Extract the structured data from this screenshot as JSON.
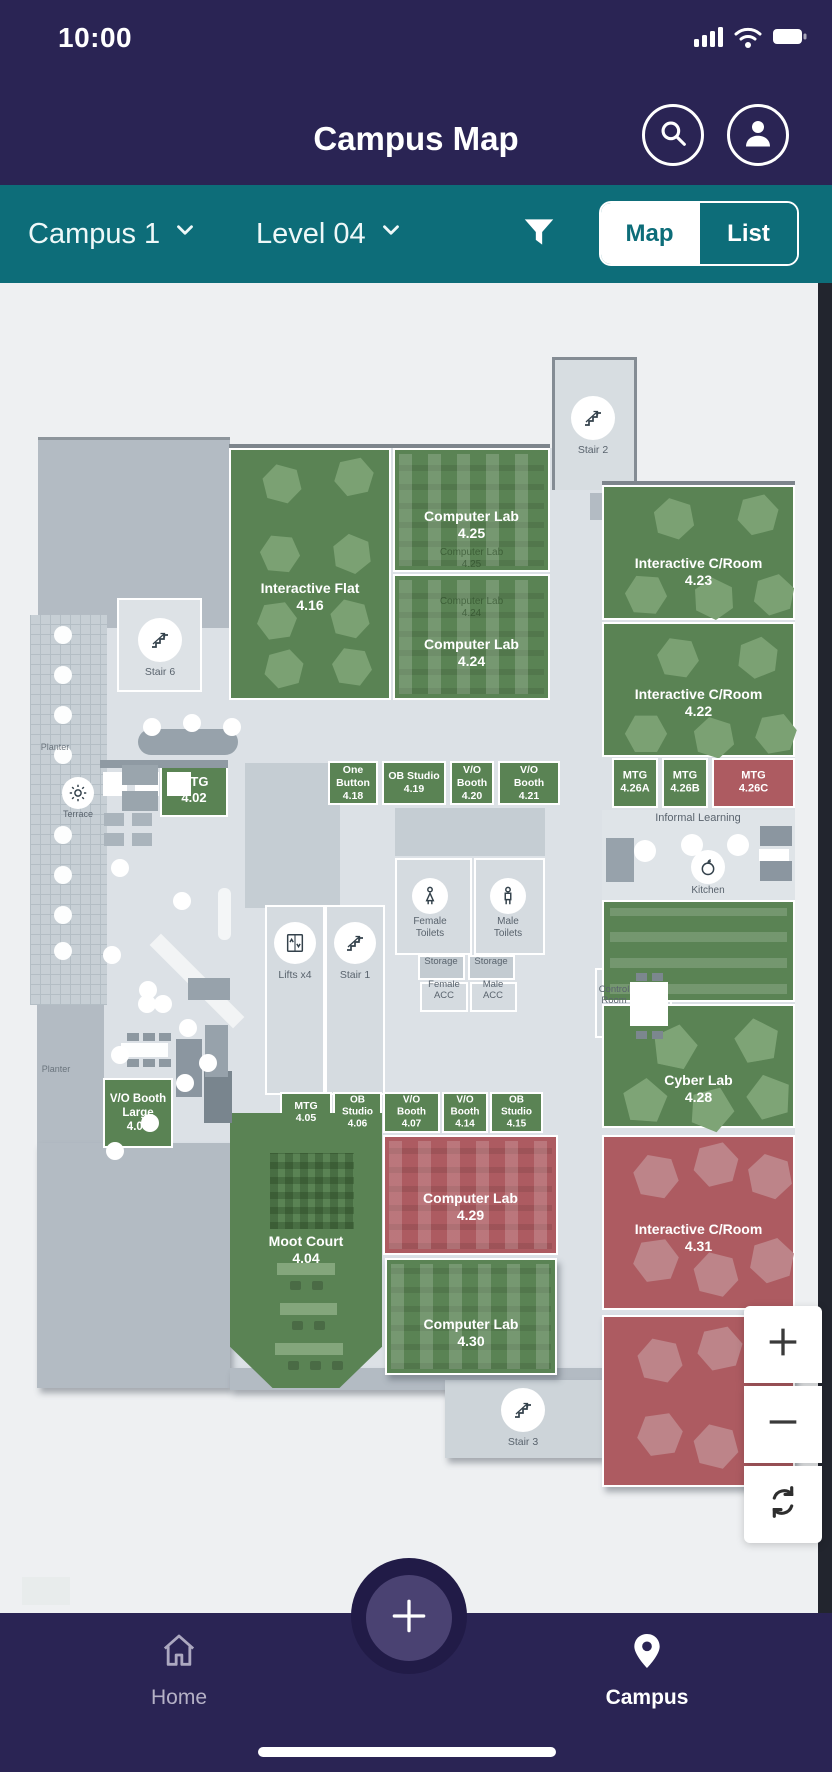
{
  "colors": {
    "navy": "#2a2454",
    "teal": "#0d6d79",
    "green_room": "#5a8354",
    "red_room": "#ad5b61",
    "map_bg": "#eef0f2",
    "floor": "#dce1e6"
  },
  "status": {
    "time": "10:00"
  },
  "header": {
    "title": "Campus Map"
  },
  "filter": {
    "campus": "Campus 1",
    "level": "Level 04",
    "map_label": "Map",
    "list_label": "List",
    "selected": "Map"
  },
  "nav": {
    "home": "Home",
    "campus": "Campus"
  },
  "map": {
    "rooms": [
      {
        "id": "interactive-flat-416",
        "lines": [
          "Interactive Flat",
          "4.16"
        ],
        "x": 229,
        "y": 165,
        "w": 162,
        "h": 252,
        "color": "green",
        "fs": 14,
        "labelTop": 130
      },
      {
        "id": "computer-lab-425",
        "lines": [
          "Computer Lab",
          "4.25"
        ],
        "x": 393,
        "y": 165,
        "w": 157,
        "h": 124,
        "color": "green",
        "fs": 14,
        "labelTop": 58,
        "pattern": "cols",
        "caption": {
          "lines": [
            "Computer Lab",
            "4.25"
          ],
          "top": 97
        }
      },
      {
        "id": "computer-lab-424",
        "lines": [
          "Computer Lab",
          "4.24"
        ],
        "x": 393,
        "y": 291,
        "w": 157,
        "h": 126,
        "color": "green",
        "fs": 14,
        "labelTop": 60,
        "pattern": "cols",
        "caption": {
          "lines": [
            "Computer Lab",
            "4.24"
          ],
          "top": 20
        }
      },
      {
        "id": "interactive-croom-423",
        "lines": [
          "Interactive C/Room",
          "4.23"
        ],
        "x": 602,
        "y": 202,
        "w": 193,
        "h": 135,
        "color": "green",
        "fs": 14,
        "labelTop": 68
      },
      {
        "id": "interactive-croom-422",
        "lines": [
          "Interactive C/Room",
          "4.22"
        ],
        "x": 602,
        "y": 339,
        "w": 193,
        "h": 135,
        "color": "green",
        "fs": 14,
        "labelTop": 62
      },
      {
        "id": "mtg-402",
        "lines": [
          "MTG",
          "4.02"
        ],
        "x": 160,
        "y": 480,
        "w": 68,
        "h": 54,
        "color": "green",
        "fs": 13
      },
      {
        "id": "one-button-418",
        "lines": [
          "One",
          "Button",
          "4.18"
        ],
        "x": 328,
        "y": 478,
        "w": 50,
        "h": 44,
        "color": "green",
        "fs": 10.5
      },
      {
        "id": "ob-studio-419",
        "lines": [
          "OB Studio",
          "4.19"
        ],
        "x": 382,
        "y": 478,
        "w": 64,
        "h": 44,
        "color": "green",
        "fs": 10.5
      },
      {
        "id": "vo-booth-420",
        "lines": [
          "V/O",
          "Booth",
          "4.20"
        ],
        "x": 450,
        "y": 478,
        "w": 44,
        "h": 44,
        "color": "green",
        "fs": 10.5
      },
      {
        "id": "vo-booth-421",
        "lines": [
          "V/O",
          "Booth",
          "4.21"
        ],
        "x": 498,
        "y": 478,
        "w": 62,
        "h": 44,
        "color": "green",
        "fs": 10.5
      },
      {
        "id": "mtg-426a",
        "lines": [
          "MTG",
          "4.26A"
        ],
        "x": 612,
        "y": 475,
        "w": 46,
        "h": 50,
        "color": "green",
        "fs": 11
      },
      {
        "id": "mtg-426b",
        "lines": [
          "MTG",
          "4.26B"
        ],
        "x": 662,
        "y": 475,
        "w": 46,
        "h": 50,
        "color": "green",
        "fs": 11
      },
      {
        "id": "mtg-426c",
        "lines": [
          "MTG",
          "4.26C"
        ],
        "x": 712,
        "y": 475,
        "w": 83,
        "h": 50,
        "color": "red",
        "fs": 11
      },
      {
        "id": "open-study-area",
        "lines": [],
        "x": 602,
        "y": 617,
        "w": 193,
        "h": 102,
        "color": "green",
        "pattern": "rows"
      },
      {
        "id": "cyber-lab-428",
        "lines": [
          "Cyber Lab",
          "4.28"
        ],
        "x": 602,
        "y": 721,
        "w": 193,
        "h": 124,
        "color": "green",
        "fs": 14,
        "labelTop": 66
      },
      {
        "id": "vo-booth-large-403",
        "lines": [
          "V/O Booth",
          "Large",
          "4.03"
        ],
        "x": 103,
        "y": 795,
        "w": 70,
        "h": 70,
        "color": "green",
        "fs": 11.5
      },
      {
        "id": "mtg-405",
        "lines": [
          "MTG",
          "4.05"
        ],
        "x": 280,
        "y": 809,
        "w": 52,
        "h": 41,
        "color": "green",
        "fs": 10.5
      },
      {
        "id": "ob-studio-406",
        "lines": [
          "OB",
          "Studio",
          "4.06"
        ],
        "x": 333,
        "y": 809,
        "w": 49,
        "h": 41,
        "color": "green",
        "fs": 10
      },
      {
        "id": "vo-booth-407",
        "lines": [
          "V/O",
          "Booth",
          "4.07"
        ],
        "x": 383,
        "y": 809,
        "w": 57,
        "h": 41,
        "color": "green",
        "fs": 10
      },
      {
        "id": "vo-booth-414",
        "lines": [
          "V/O",
          "Booth",
          "4.14"
        ],
        "x": 442,
        "y": 809,
        "w": 46,
        "h": 41,
        "color": "green",
        "fs": 10
      },
      {
        "id": "ob-studio-415",
        "lines": [
          "OB",
          "Studio",
          "4.15"
        ],
        "x": 490,
        "y": 809,
        "w": 53,
        "h": 41,
        "color": "green",
        "fs": 10
      },
      {
        "id": "moot-court-404",
        "lines": [
          "Moot Court",
          "4.04"
        ],
        "x": 230,
        "y": 830,
        "w": 152,
        "h": 275,
        "color": "green",
        "fs": 14,
        "labelTop": 120,
        "clip": "polygon(0 0,100% 0,100% 85%,72% 100%,28% 100%,0 85%)"
      },
      {
        "id": "computer-lab-429",
        "lines": [
          "Computer Lab",
          "4.29"
        ],
        "x": 383,
        "y": 852,
        "w": 175,
        "h": 120,
        "color": "red",
        "fs": 14,
        "labelTop": 53,
        "pattern": "cols"
      },
      {
        "id": "computer-lab-430",
        "lines": [
          "Computer Lab",
          "4.30"
        ],
        "x": 385,
        "y": 975,
        "w": 172,
        "h": 117,
        "color": "green",
        "fs": 14,
        "labelTop": 56,
        "pattern": "cols",
        "shadow": true
      },
      {
        "id": "interactive-croom-431",
        "lines": [
          "Interactive C/Room",
          "4.31"
        ],
        "x": 602,
        "y": 852,
        "w": 193,
        "h": 175,
        "color": "red",
        "fs": 14,
        "labelTop": 84
      },
      {
        "id": "interactive-croom-431-south",
        "lines": [],
        "x": 602,
        "y": 1032,
        "w": 193,
        "h": 172,
        "color": "red",
        "shadow": true
      }
    ],
    "facilities": [
      {
        "id": "stair-2",
        "icon": "stairs",
        "cx": 593,
        "cy": 135,
        "r": 22,
        "label": [
          "Stair 2"
        ],
        "ldy": 12,
        "fs": 10.5
      },
      {
        "id": "stair-6",
        "icon": "stairs",
        "cx": 160,
        "cy": 357,
        "r": 22,
        "label": [
          "Stair 6"
        ],
        "ldy": 12,
        "fs": 10.5
      },
      {
        "id": "lifts-x4",
        "icon": "lift",
        "cx": 295,
        "cy": 660,
        "r": 21,
        "label": [
          "Lifts x4"
        ],
        "ldy": 13,
        "fs": 10.5
      },
      {
        "id": "stair-1",
        "icon": "stairs",
        "cx": 355,
        "cy": 660,
        "r": 21,
        "label": [
          "Stair 1"
        ],
        "ldy": 13,
        "fs": 10.5
      },
      {
        "id": "stair-3",
        "icon": "stairs",
        "cx": 523,
        "cy": 1127,
        "r": 22,
        "label": [
          "Stair 3"
        ],
        "ldy": 12,
        "fs": 10.5
      },
      {
        "id": "female-toilets",
        "icon": "female",
        "cx": 430,
        "cy": 613,
        "r": 18,
        "label": [
          "Female",
          "Toilets"
        ],
        "ldy": 10,
        "fs": 10
      },
      {
        "id": "male-toilets",
        "icon": "male",
        "cx": 508,
        "cy": 613,
        "r": 18,
        "label": [
          "Male",
          "Toilets"
        ],
        "ldy": 10,
        "fs": 10
      },
      {
        "id": "kitchen",
        "icon": "apple",
        "cx": 708,
        "cy": 584,
        "r": 17,
        "label": [
          "Kitchen"
        ],
        "ldy": 9,
        "fs": 10
      },
      {
        "id": "terrace",
        "icon": "sun",
        "cx": 78,
        "cy": 510,
        "r": 16,
        "label": [
          "Terrace"
        ],
        "ldy": 8,
        "fs": 9
      }
    ],
    "labels": [
      {
        "id": "informal-learning",
        "lines": [
          "Informal Learning"
        ],
        "x": 698,
        "y": 536,
        "fs": 11,
        "c": "#5a646e"
      },
      {
        "id": "planter-north",
        "lines": [
          "Planter"
        ],
        "x": 55,
        "y": 466,
        "fs": 9,
        "c": "#6a747d"
      },
      {
        "id": "planter-south",
        "lines": [
          "Planter"
        ],
        "x": 56,
        "y": 788,
        "fs": 9,
        "c": "#6a747d"
      },
      {
        "id": "control-room",
        "lines": [
          "Control",
          "Room"
        ],
        "x": 614,
        "y": 708,
        "fs": 9.5,
        "c": "#59636d"
      },
      {
        "id": "storage-1",
        "lines": [
          "Storage"
        ],
        "x": 441,
        "y": 680,
        "fs": 9.5,
        "c": "#59636d"
      },
      {
        "id": "storage-2",
        "lines": [
          "Storage"
        ],
        "x": 491,
        "y": 680,
        "fs": 9.5,
        "c": "#59636d"
      },
      {
        "id": "female-acc",
        "lines": [
          "Female",
          "ACC"
        ],
        "x": 444,
        "y": 703,
        "fs": 9.5,
        "c": "#59636d"
      },
      {
        "id": "male-acc",
        "lines": [
          "Male",
          "ACC"
        ],
        "x": 493,
        "y": 703,
        "fs": 9.5,
        "c": "#59636d"
      }
    ]
  }
}
